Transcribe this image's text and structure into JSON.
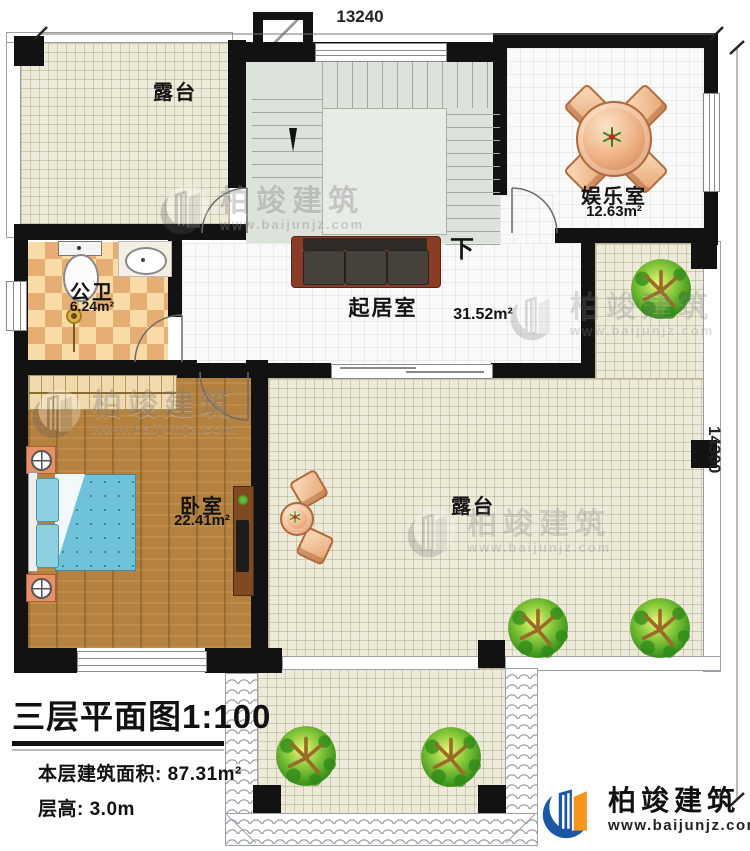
{
  "dimensions": {
    "top": "13240",
    "right": "14300"
  },
  "plan": {
    "title": "三层平面图",
    "scale": "1:100",
    "area_label": "本层建筑面积:",
    "area_value": "87.31m²",
    "floor_height_label": "层高:",
    "floor_height_value": "3.0m"
  },
  "rooms": {
    "terrace_top": {
      "label": "露台"
    },
    "entertainment": {
      "label": "娱乐室",
      "area": "12.63m²"
    },
    "bathroom": {
      "label": "公卫",
      "area": "6.24m²"
    },
    "living": {
      "label": "起居室",
      "area": "31.52m²"
    },
    "bedroom": {
      "label": "卧室",
      "area": "22.41m²"
    },
    "terrace_main": {
      "label": "露台"
    }
  },
  "stairs": {
    "down": "下"
  },
  "brand": {
    "name": "柏竣建筑",
    "website": "www.baijunjz.com"
  },
  "colors": {
    "wall": "#121212",
    "terrace_floor": "#edead9",
    "wood_floor": "#b5813f",
    "checker_light": "#f8dba6",
    "checker_dark": "#e7ae74",
    "stair_floor": "#dce3da",
    "tree_green": "#2e8a16",
    "brand_blue": "#1c57a5",
    "brand_orange": "#f7941d"
  }
}
